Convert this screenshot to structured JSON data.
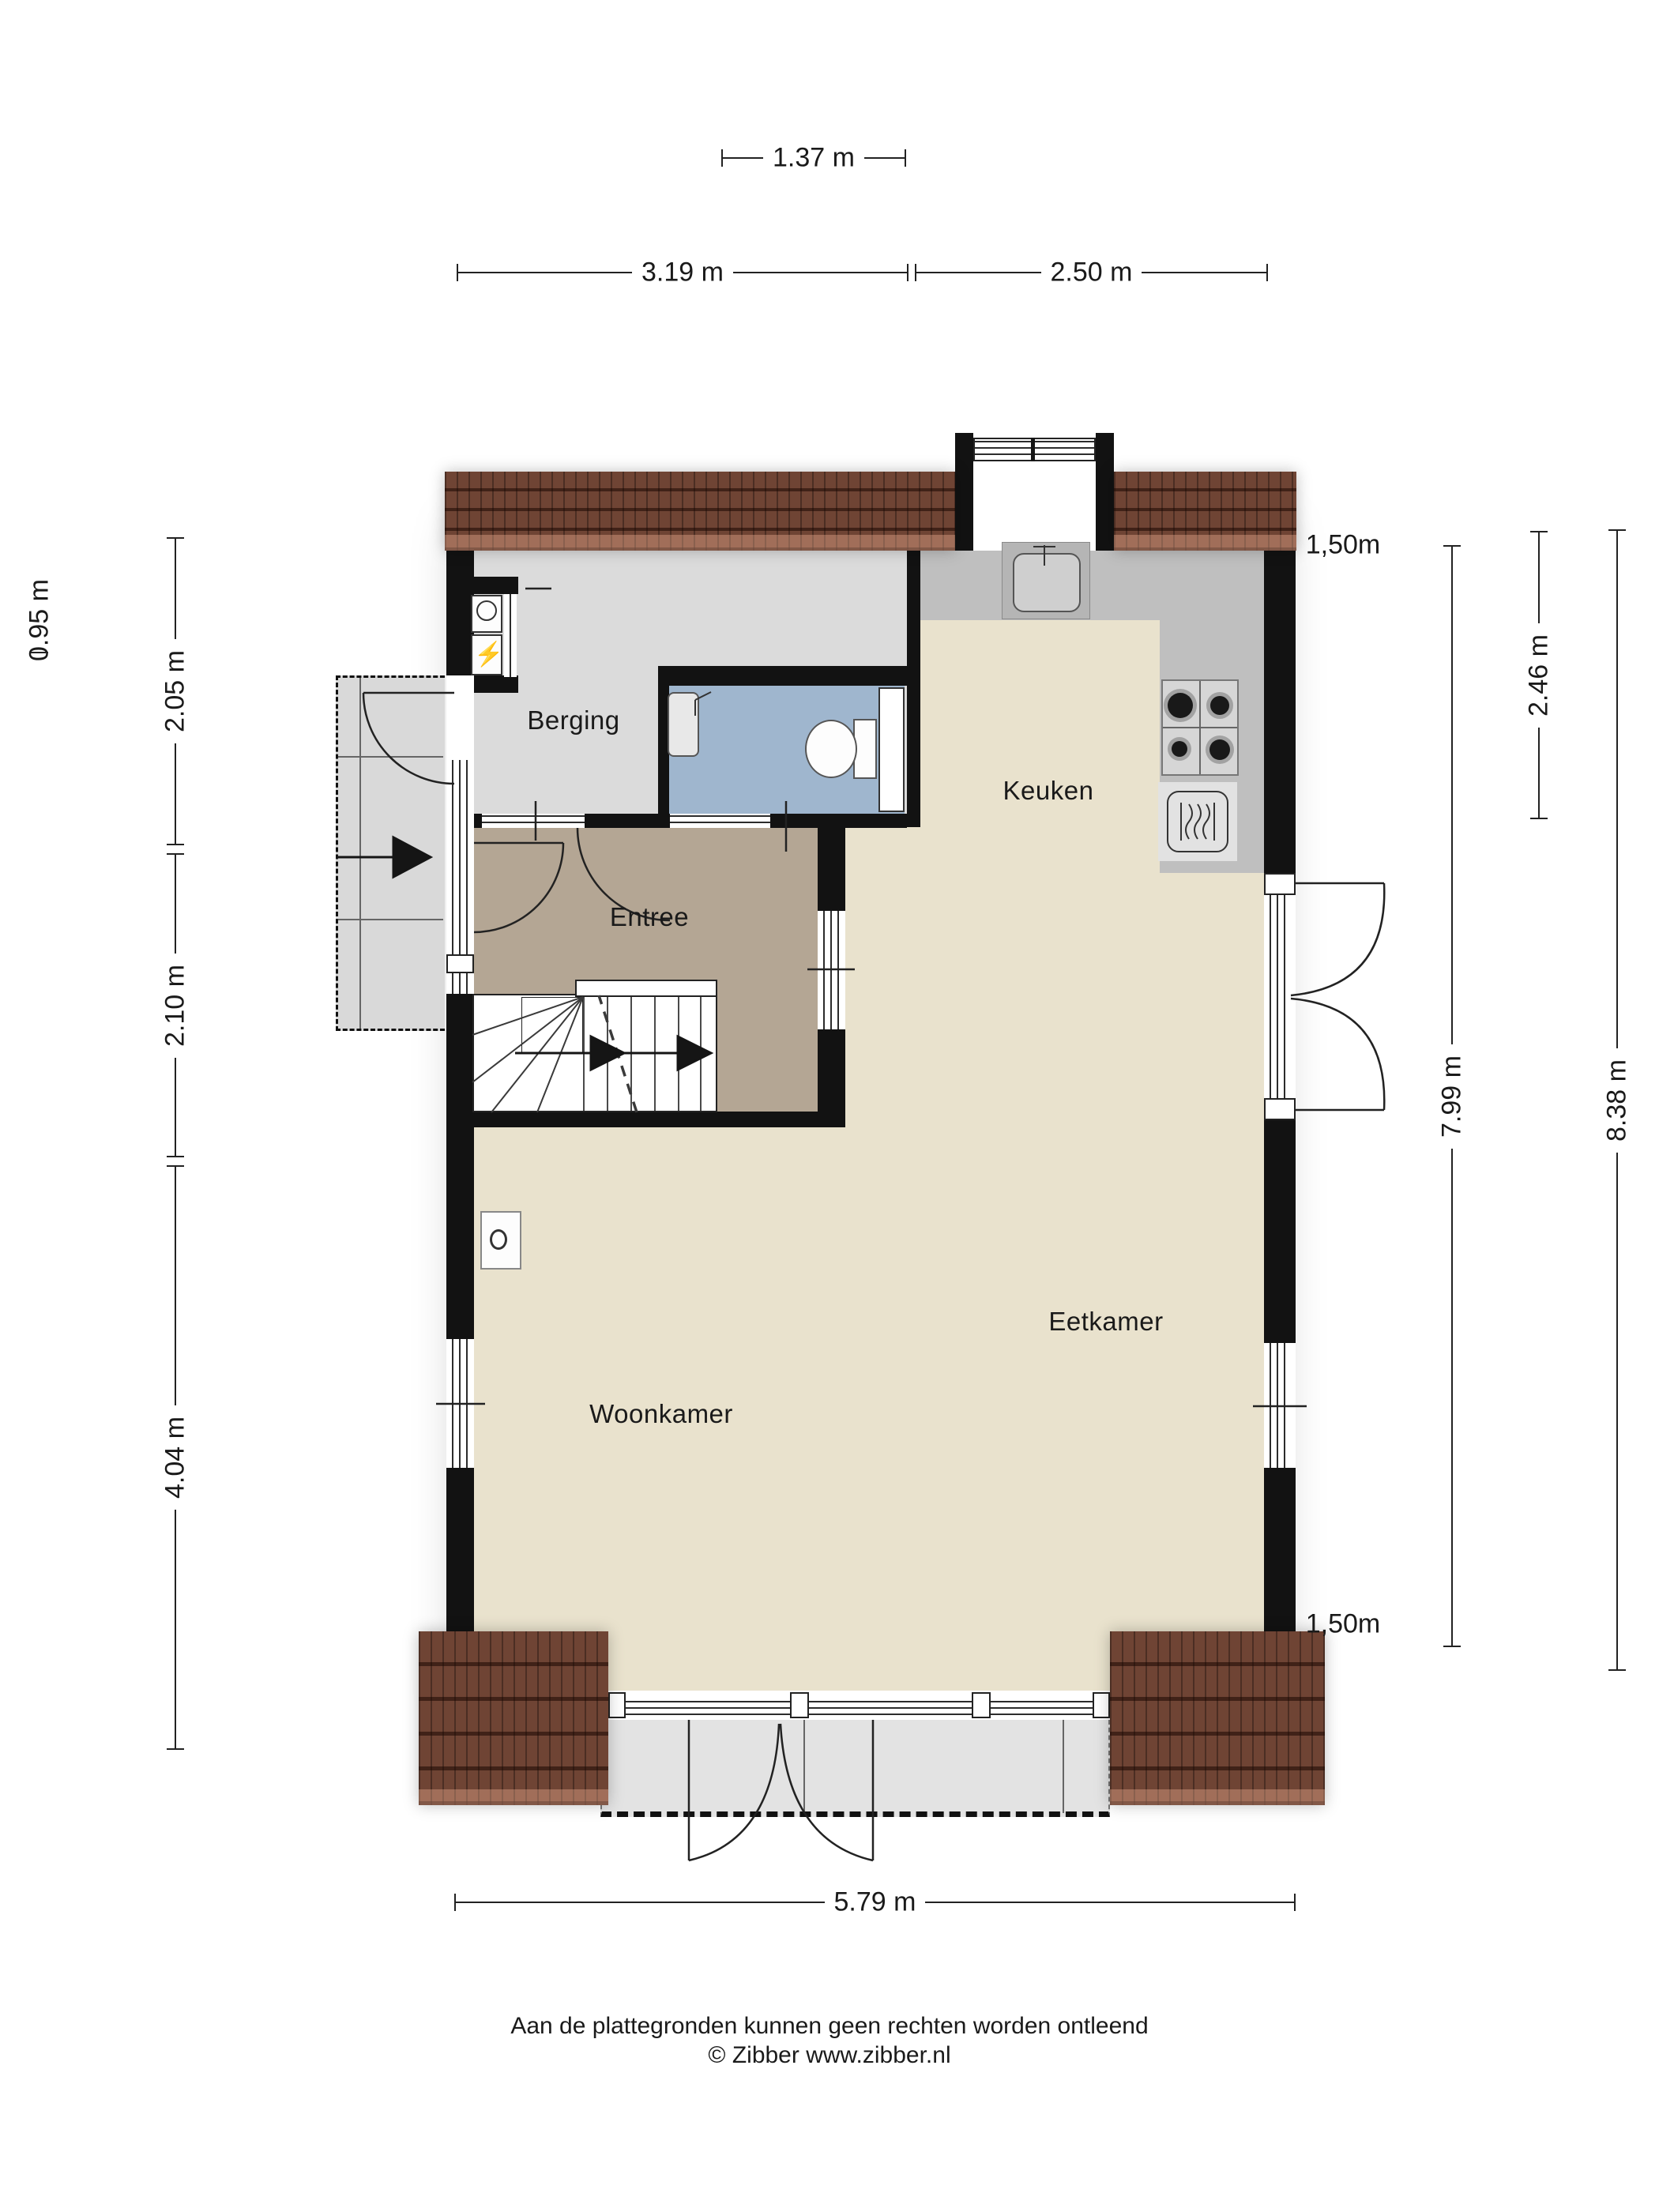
{
  "rooms": {
    "berging": "Berging",
    "entree": "Entree",
    "keuken": "Keuken",
    "eetkamer": "Eetkamer",
    "woonkamer": "Woonkamer"
  },
  "dims": {
    "win_top": "1.37 m",
    "top_left": "3.19 m",
    "top_right": "2.50 m",
    "left_small": "0.95 m",
    "left_1": "2.05 m",
    "left_2": "2.10 m",
    "left_3": "4.04 m",
    "right_h_top": "1,50m",
    "right_1": "2.46 m",
    "right_2": "7.99 m",
    "right_3": "8.38 m",
    "right_h_bottom": "1,50m",
    "bottom": "5.79 m"
  },
  "footer": {
    "disclaimer": "Aan de plattegronden kunnen geen rechten worden ontleend",
    "credit": "© Zibber www.zibber.nl"
  },
  "colors": {
    "wall": "#121212",
    "roof": "#6f4434",
    "floor_main": "#e9e2cd",
    "floor_berging": "#dbdbdb",
    "floor_entree": "#b4a694",
    "floor_toilet": "#9fb6ce",
    "counter": "#bfbfbf",
    "porch": "#d9d9d9",
    "patio": "#e3e3e3"
  },
  "icons": {
    "stove": "gas-hob-4-burners",
    "oven": "oven-icon",
    "sink_kitchen": "kitchen-sink-icon",
    "sink_toilet": "hand-basin-icon",
    "toilet": "toilet-icon",
    "boiler": "boiler-icon",
    "meter": "electric-meter-icon",
    "fireplace": "stove-pipe-icon",
    "entrance_arrow": "entrance-arrow-icon",
    "stairs": "staircase-up-icon"
  }
}
